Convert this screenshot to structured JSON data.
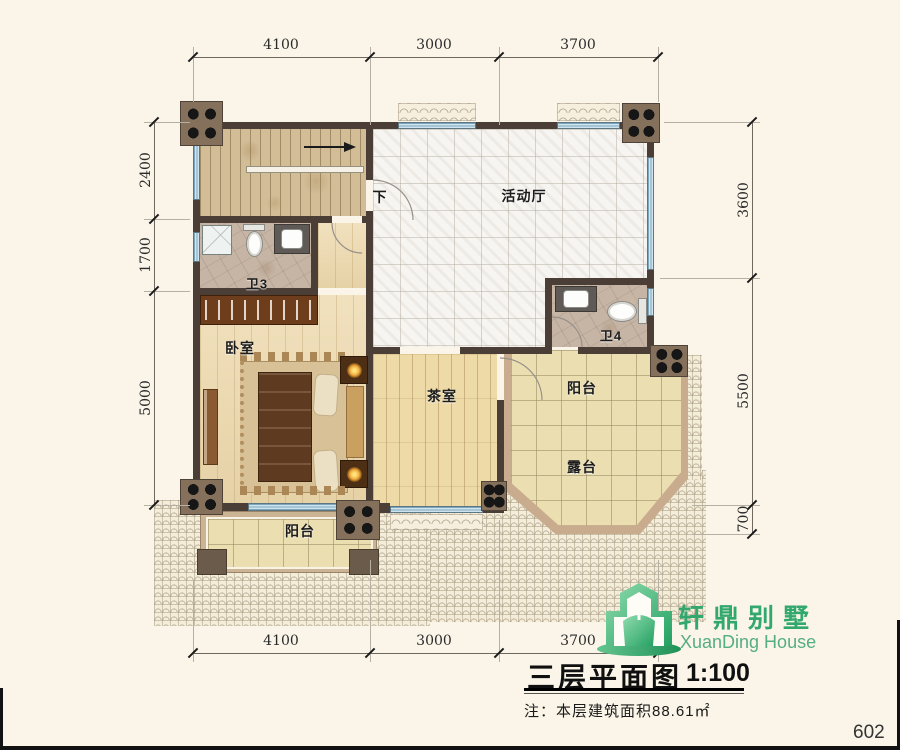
{
  "dims": {
    "top": [
      "4100",
      "3000",
      "3700"
    ],
    "bottom": [
      "4100",
      "3000",
      "3700"
    ],
    "left": [
      "2400",
      "1700",
      "5000"
    ],
    "right": [
      "3600",
      "5500",
      "700"
    ]
  },
  "rooms": {
    "hall": "活动厅",
    "down": "下",
    "bath3": "卫3",
    "bedroom": "卧室",
    "tea": "茶室",
    "bath4": "卫4",
    "balcony_right": "阳台",
    "terrace": "露台",
    "balcony_bottom": "阳台"
  },
  "logo": {
    "name_cn": "轩鼎别墅",
    "name_en": "XuanDing House",
    "green": "#33a86e"
  },
  "titleblock": {
    "title": "三层平面图",
    "scale": "1:100",
    "note": "注：本层建筑面积88.61㎡"
  },
  "page": {
    "number": "602"
  }
}
